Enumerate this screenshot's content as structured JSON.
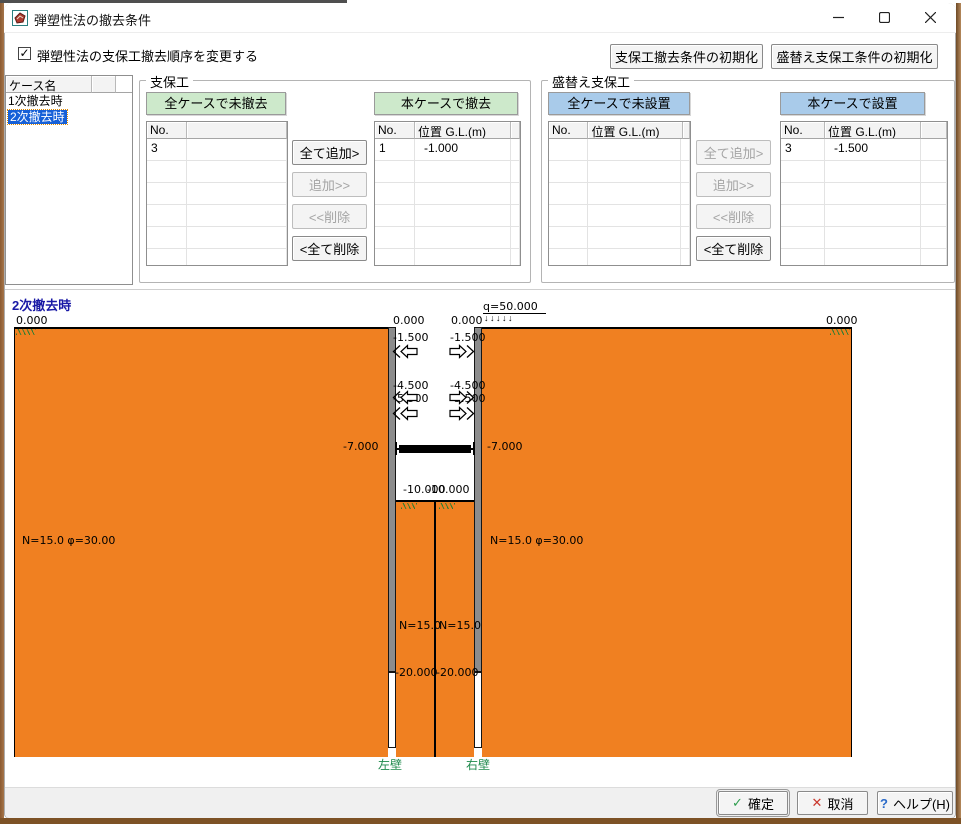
{
  "window": {
    "title": "弾塑性法の撤去条件"
  },
  "header": {
    "checkbox_glyph": "✓",
    "checkbox_label": "弾塑性法の支保工撤去順序を変更する",
    "init_shoring": "支保工撤去条件の初期化",
    "init_reshoring": "盛替え支保工条件の初期化"
  },
  "case_panel": {
    "header": "ケース名",
    "items": [
      {
        "label": "1次撤去時"
      },
      {
        "label": "2次撤去時"
      }
    ],
    "selected": "2次撤去時"
  },
  "shoring": {
    "group_title": "支保工",
    "left_table": {
      "banner": "全ケースで未撤去",
      "columns": [
        "No.",
        ""
      ],
      "rows": [
        [
          "3",
          ""
        ]
      ]
    },
    "right_table": {
      "banner": "本ケースで撤去",
      "columns": [
        "No.",
        "位置 G.L.(m)"
      ],
      "rows": [
        [
          "1",
          "-1.000"
        ]
      ]
    },
    "buttons": [
      {
        "label": "全て追加>",
        "enabled": true
      },
      {
        "label": "追加>>",
        "enabled": false
      },
      {
        "label": "<<削除",
        "enabled": false
      },
      {
        "label": "<全て削除",
        "enabled": true
      }
    ]
  },
  "reshoring": {
    "group_title": "盛替え支保工",
    "left_table": {
      "banner": "全ケースで未設置",
      "columns": [
        "No.",
        "位置 G.L.(m)"
      ],
      "rows": []
    },
    "right_table": {
      "banner": "本ケースで設置",
      "columns": [
        "No.",
        "位置 G.L.(m)"
      ],
      "rows": [
        [
          "3",
          "-1.500"
        ]
      ]
    },
    "buttons": [
      {
        "label": "全て追加>",
        "enabled": false
      },
      {
        "label": "追加>>",
        "enabled": false
      },
      {
        "label": "<<削除",
        "enabled": false
      },
      {
        "label": "<全て削除",
        "enabled": true
      }
    ]
  },
  "diagram": {
    "title": "2次撤去時",
    "surface_far_left": "0.000",
    "surface_inner_left": "0.000",
    "surface_inner_right": "0.000",
    "surface_far_right": "0.000",
    "surcharge": "q=50.000",
    "surcharge_arrows": "↓↓↓↓↓",
    "left_levels": [
      "-1.500",
      "-4.500",
      "-5.500"
    ],
    "right_levels": [
      "-1.500",
      "-4.500",
      "-5.500"
    ],
    "strut_left": "-7.000",
    "strut_right": "-7.000",
    "bottom_left": "-10.000",
    "bottom_right": "-10.000",
    "tip_left": "-20.000",
    "tip_right": "-20.000",
    "soil_left": "N=15.0  φ=30.00",
    "soil_right": "N=15.0  φ=30.00",
    "col_left": "N=15.0",
    "col_right": "N=15.0",
    "wall_left": "左壁",
    "wall_right": "右壁"
  },
  "footer": {
    "confirm_glyph": "✓",
    "confirm": "確定",
    "cancel_glyph": "✕",
    "cancel": "取消",
    "help_glyph": "?",
    "help": "ヘルプ(H)"
  },
  "colors": {
    "soil-orange": "#F08021",
    "header-green": "#CDE9CB",
    "header-blue": "#A9CBEA",
    "selection-blue": "#1660D8",
    "diagram-title-blue": "#1A1AA6",
    "wall-label-green": "#1F8A4C",
    "wall-gray": "#8C8C8C",
    "ok-green": "#2F9E4F",
    "cancel-red": "#C9372C",
    "help-blue": "#2B6BC9"
  }
}
